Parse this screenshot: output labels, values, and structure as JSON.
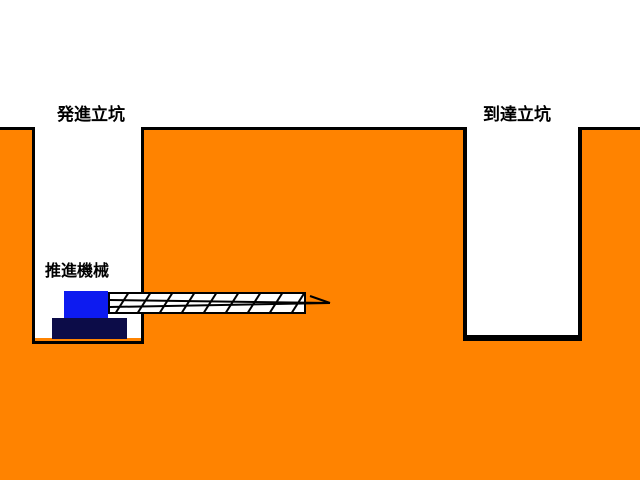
{
  "diagram": {
    "labels": {
      "start_shaft": "発進立坑",
      "arrival_shaft": "到達立坑",
      "machine": "推進機械"
    },
    "colors": {
      "background": "#FFFFFF",
      "ground": "#FF8300",
      "outline": "#000000",
      "shaft_interior": "#FFFFFF",
      "pipe_fill": "#FFFFFF",
      "machine_body": "#0D1BF0",
      "machine_base": "#0C0C48"
    }
  }
}
